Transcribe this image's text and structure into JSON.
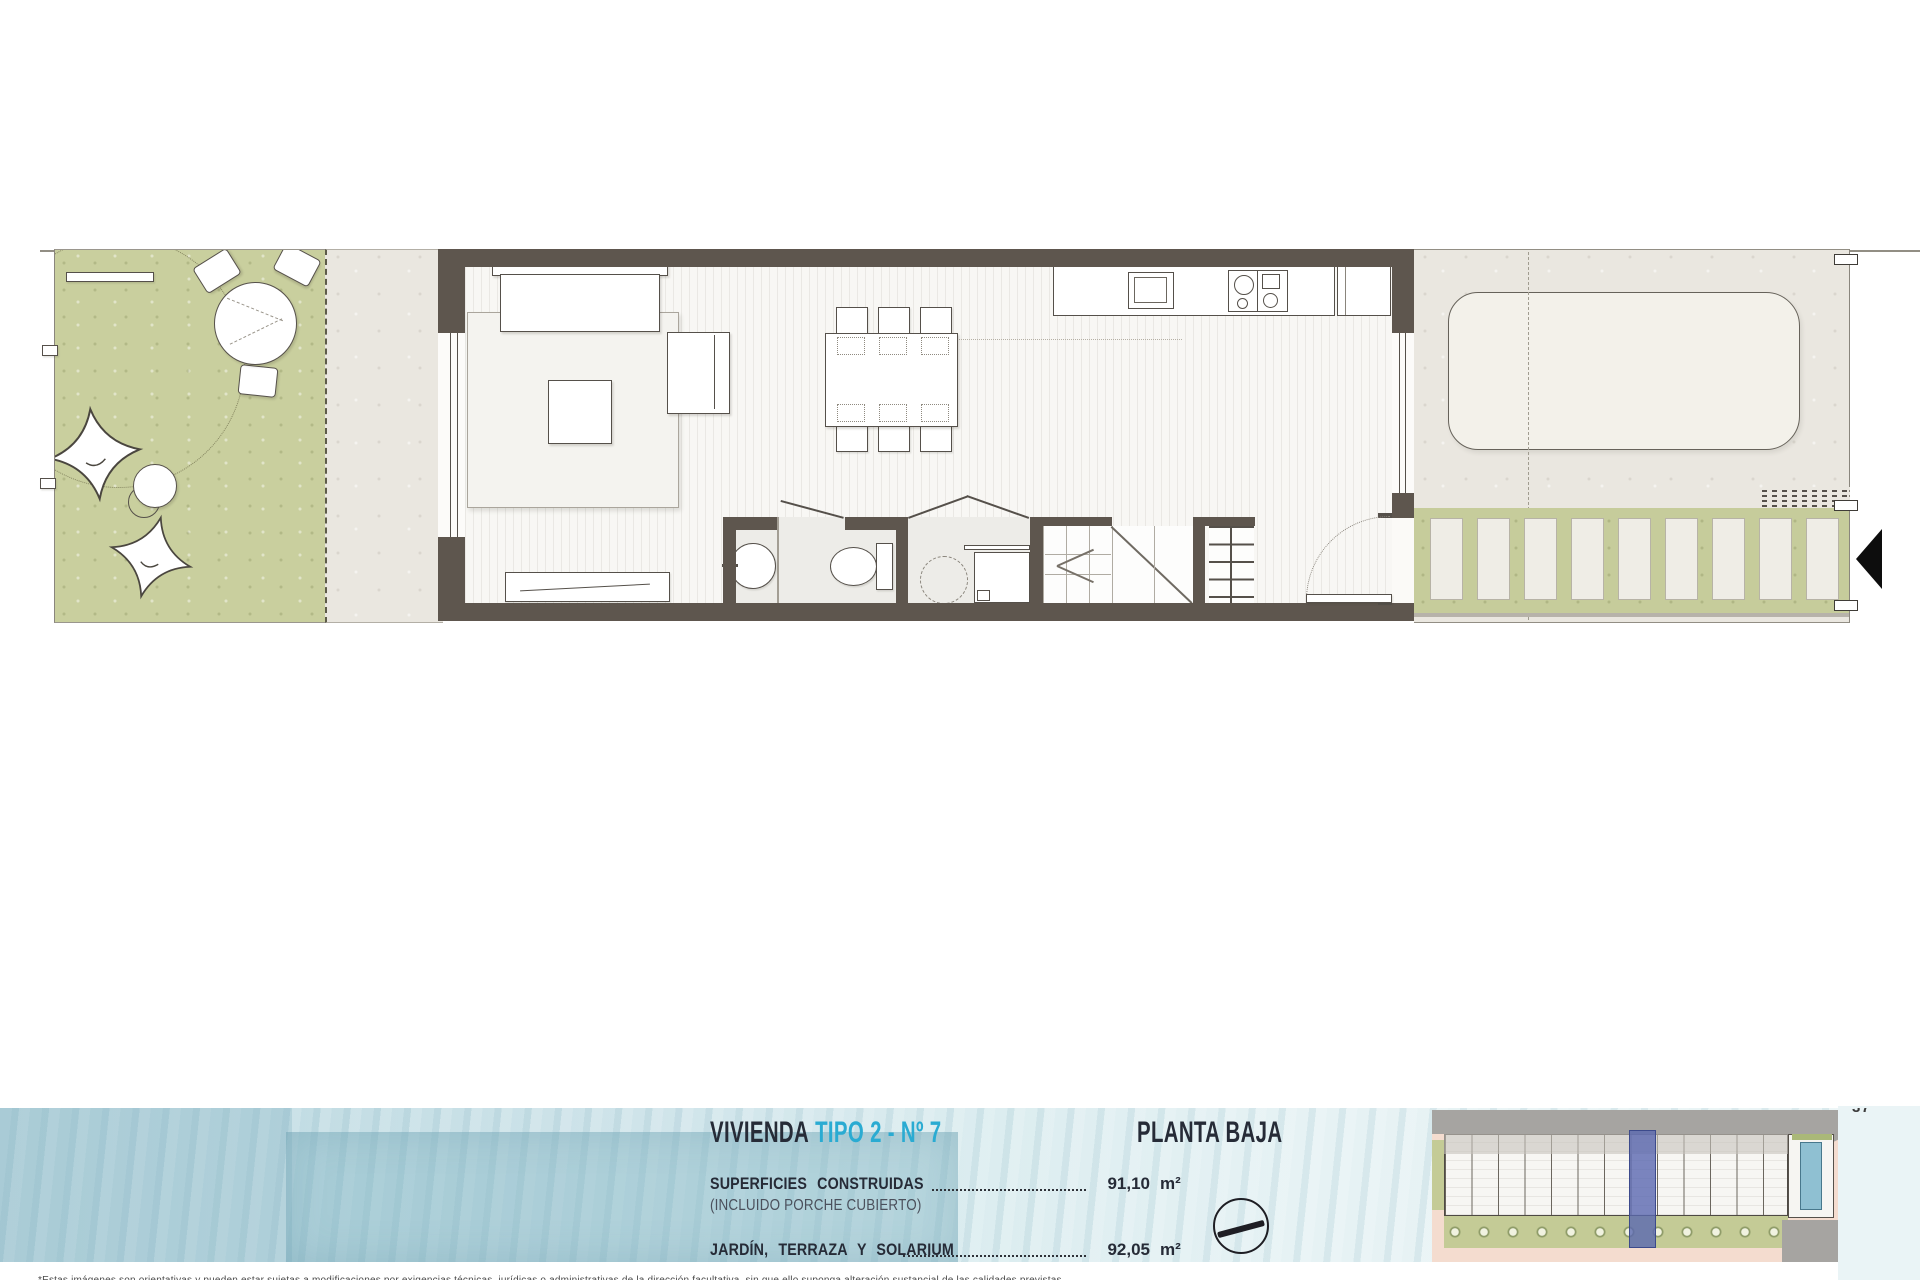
{
  "title_block": {
    "heading": {
      "name": "VIVIENDA",
      "variant": "TIPO 2 - Nº 7"
    },
    "floor_label": "PLANTA BAJA",
    "rows": [
      {
        "label": "SUPERFICIES CONSTRUIDAS",
        "sublabel": "(INCLUIDO PORCHE CUBIERTO)",
        "value": "91,10",
        "unit": "m²"
      },
      {
        "label": "JARDÍN, TERRAZA Y SOLARIUM",
        "value": "92,05",
        "unit": "m²"
      }
    ],
    "accent_color": "#2aabd2",
    "text_color": "#262b37"
  },
  "page": {
    "number": "37",
    "disclaimer": "*Estas imágenes son orientativas y pueden estar sujetas a modificaciones por exigencias técnicas, jurídicas o administrativas de la dirección facultativa, sin que ello suponga alteración sustancial de las calidades previstas."
  },
  "plan": {
    "palette": {
      "wall": "#5e564e",
      "line": "#55504a",
      "garden_green": "#c9cf9e",
      "walkway_green": "#c6cc9b",
      "paving": "#eae7e0",
      "floor": "#f8f7f4",
      "bath_floor": "#edece8",
      "water_blue": "#cfe4ea"
    },
    "furniture_icons": [
      "garden-table",
      "garden-chairs",
      "pouf",
      "side-table",
      "sofa",
      "rug",
      "coffee-table",
      "armchair",
      "tv-console",
      "dining-table",
      "dining-chairs",
      "kitchen-counter",
      "kitchen-sink",
      "cooktop",
      "fridge",
      "washbasin",
      "toilet",
      "washing-machine",
      "stairs",
      "shelving-unit",
      "parking-car",
      "walkway-planks",
      "drain-grate",
      "entrance-arrow"
    ]
  },
  "site_plan": {
    "units_visible": 12,
    "highlight_color": "#5a68b0",
    "ground_color": "#f4dccf",
    "road_color": "#a6a4a1",
    "green_color": "#c4cb96",
    "pool_color": "#8fc0d2"
  }
}
